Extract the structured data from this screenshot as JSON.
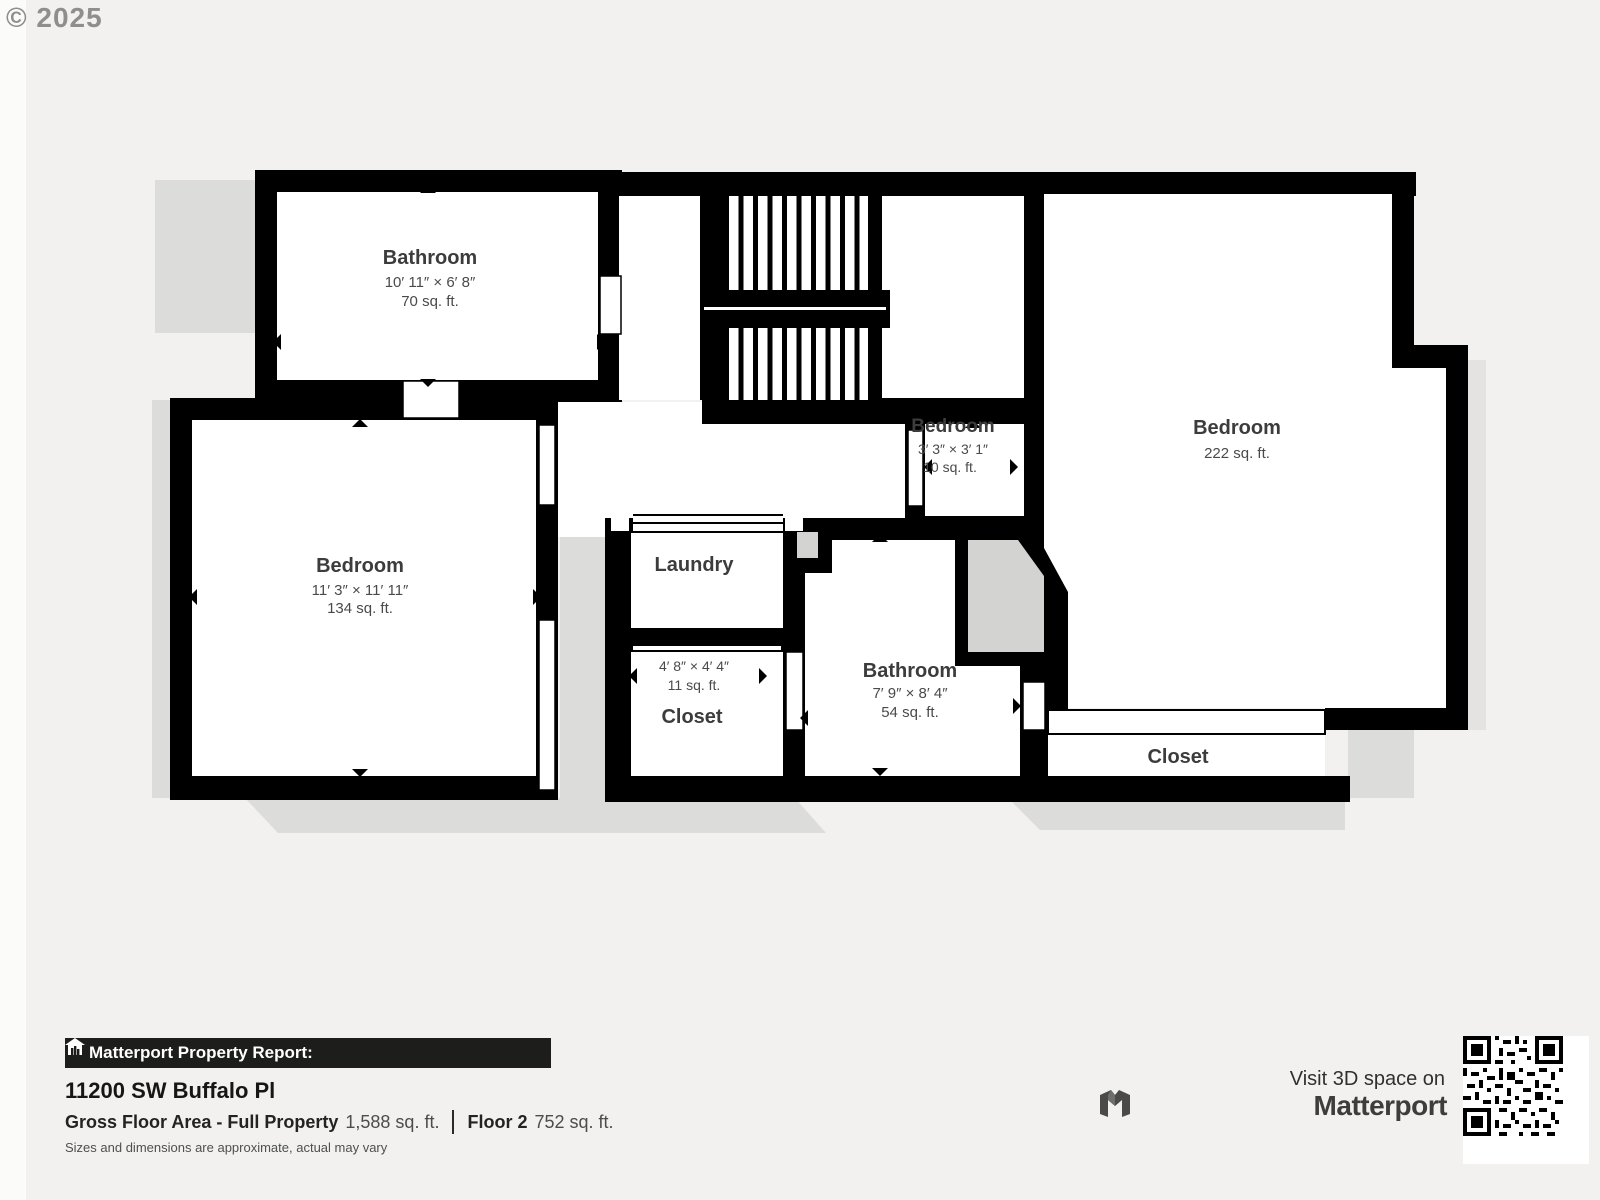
{
  "copyright": "© 2025",
  "rooms": {
    "bathroom_top": {
      "name": "Bathroom",
      "dims": "10′ 11″ × 6′ 8″",
      "area": "70 sq. ft."
    },
    "bedroom_left": {
      "name": "Bedroom",
      "dims": "11′ 3″ × 11′ 11″",
      "area": "134 sq. ft."
    },
    "bedroom_small": {
      "name": "Bedroom",
      "dims": "3′ 3″ × 3′ 1″",
      "area": "10 sq. ft."
    },
    "bedroom_right": {
      "name": "Bedroom",
      "area": "222 sq. ft."
    },
    "laundry": {
      "name": "Laundry"
    },
    "closet_middle": {
      "name": "Closet",
      "dims": "4′ 8″ × 4′ 4″",
      "area": "11 sq. ft."
    },
    "bathroom_middle": {
      "name": "Bathroom",
      "dims": "7′ 9″ × 8′ 4″",
      "area": "54 sq. ft."
    },
    "closet_right": {
      "name": "Closet"
    }
  },
  "footer": {
    "report_banner": "Matterport Property Report:",
    "address": "11200 SW Buffalo Pl",
    "gross_label": "Gross Floor Area - Full Property",
    "gross_value": "1,588 sq. ft.",
    "floor_label": "Floor 2",
    "floor_value": "752 sq. ft.",
    "disclaimer": "Sizes and dimensions are approximate, actual may vary",
    "visit": "Visit 3D space on",
    "brand": "Matterport"
  },
  "colors": {
    "background": "#f2f1ef",
    "wall": "#000000",
    "shadow": "#dcdcdb",
    "banner": "#1d1d1b"
  }
}
